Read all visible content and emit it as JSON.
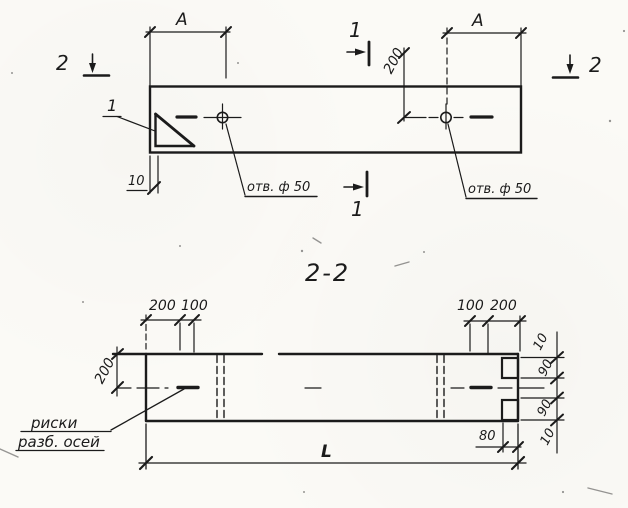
{
  "meta": {
    "kind": "technical-drawing",
    "language": "ru"
  },
  "colors": {
    "ink": "#1b1b1b",
    "paper": "#fbfaf6"
  },
  "top_view": {
    "span_a_left": "A",
    "span_a_right": "A",
    "section1_marker_top": "1",
    "section1_marker_bottom": "1",
    "section2_marker_left": "2",
    "section2_marker_right": "2",
    "dim_hole_offset": "200",
    "chamfer_detail_ref": "1",
    "hole_label_left": "отв. ф 50",
    "hole_label_right": "отв. ф 50",
    "dim_chamfer": "10"
  },
  "section_view": {
    "title": "2-2",
    "dim_left_200": "200",
    "dim_left_100": "100",
    "dim_right_100": "100",
    "dim_right_200": "200",
    "dim_height": "200",
    "axis_marks_label_line1": "риски",
    "axis_marks_label_line2": "разб. осей",
    "dim_length": "L",
    "dim_notch_depth": "80",
    "dims_edge": [
      "10",
      "90",
      "90",
      "10"
    ]
  }
}
